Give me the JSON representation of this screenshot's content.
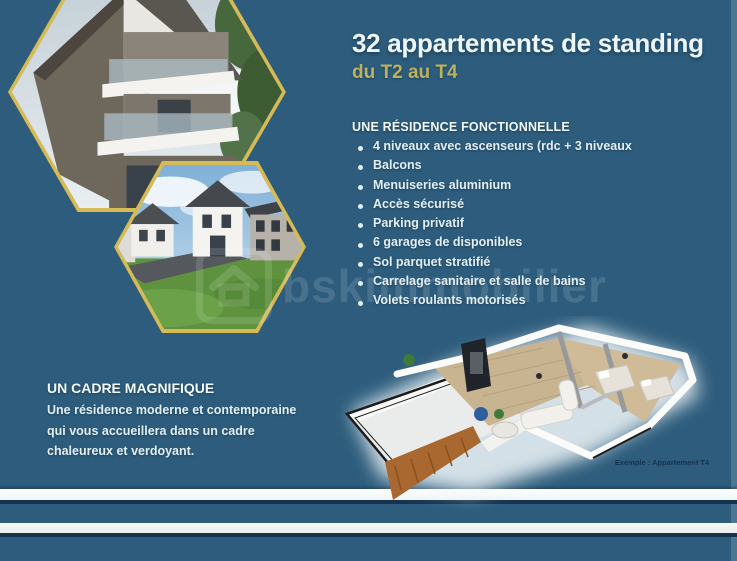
{
  "page": {
    "background_color": "#2d5c7c",
    "accent_gold": "#d6bb55",
    "stripe_white": "#f3f6f7",
    "stripe_dark": "#14334d",
    "watermark": {
      "text": "bskimmobilier",
      "logo": "house-logo"
    }
  },
  "header": {
    "title": "32 appartements de standing",
    "subtitle": "du T2 au T4",
    "title_color": "#ecf6f9",
    "subtitle_color": "#bcb163"
  },
  "features": {
    "heading": "UNE RÉSIDENCE FONCTIONNELLE",
    "items": [
      "4 niveaux avec ascenseurs (rdc + 3 niveaux",
      "Balcons",
      "Menuiseries aluminium",
      "Accès sécurisé",
      "Parking privatif",
      "6 garages de disponibles",
      "Sol parquet stratifié",
      "Carrelage sanitaire et salle de bains",
      "Volets roulants motorisés"
    ]
  },
  "cadre": {
    "heading": "UN CADRE MAGNIFIQUE",
    "body": "Une résidence moderne et contemporaine qui vous accueillera dans un cadre chaleureux et verdoyant."
  },
  "floorplan": {
    "caption": "Exemple : Appartement T4"
  },
  "photos": {
    "hexagon1": "modern-residence-building-render",
    "hexagon2": "residence-houses-street-render",
    "border_color": "#d6bb55"
  }
}
